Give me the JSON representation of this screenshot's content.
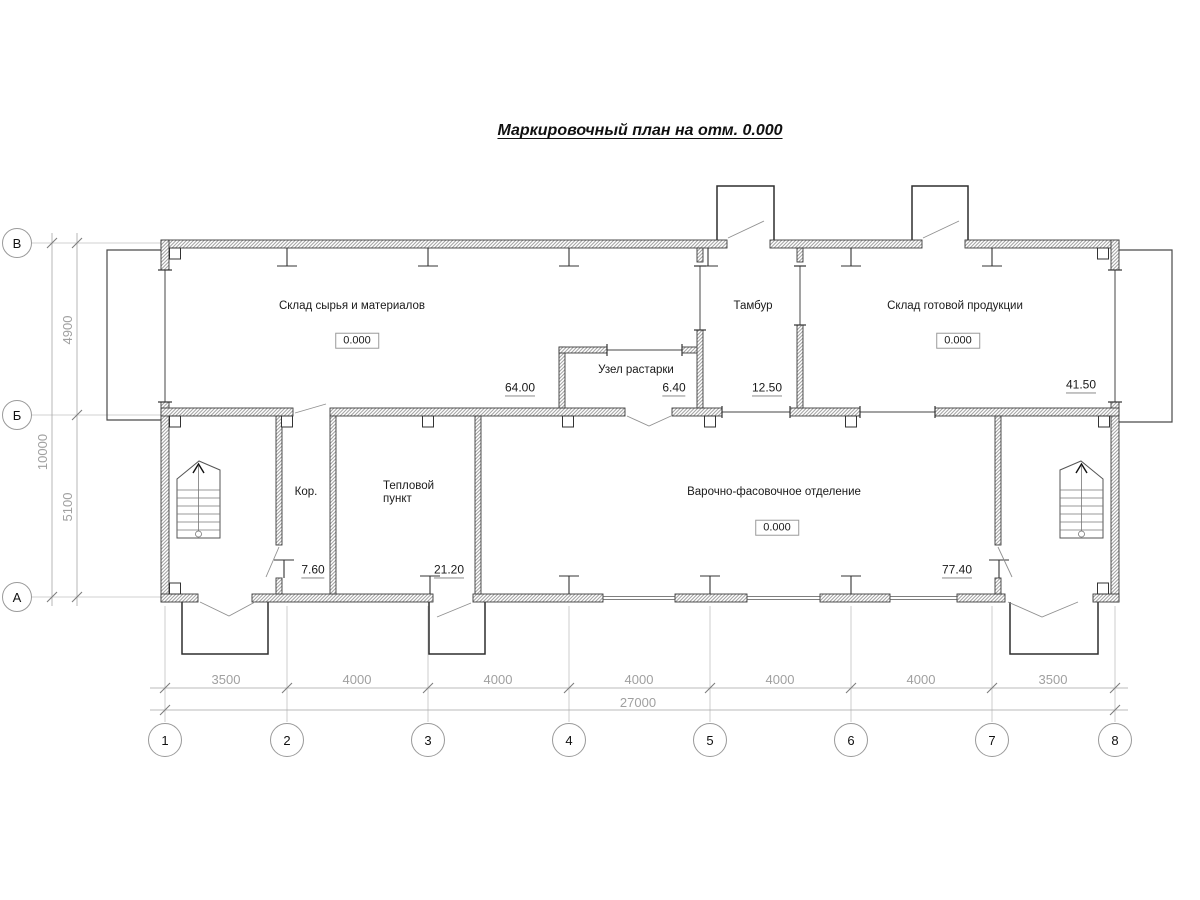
{
  "title": "Маркировочный план на отм. 0.000",
  "rooms": {
    "skladSyrya": {
      "name": "Склад сырья и материалов",
      "elevation": "0.000",
      "area": "64.00"
    },
    "uzelRastarki": {
      "name": "Узел растарки",
      "area": "6.40"
    },
    "tambur": {
      "name": "Тамбур",
      "area": "12.50"
    },
    "skladGotovoy": {
      "name": "Склад готовой продукции",
      "elevation": "0.000",
      "area": "41.50"
    },
    "koridor": {
      "name": "Кор.",
      "area": "7.60"
    },
    "teplopunkt": {
      "name": "Тепловой пункт",
      "area": "21.20"
    },
    "varochnoe": {
      "name": "Варочно-фасовочное отделение",
      "elevation": "0.000",
      "area": "77.40"
    }
  },
  "axes": {
    "row_labels": [
      "В",
      "Б",
      "А"
    ],
    "col_labels": [
      "1",
      "2",
      "3",
      "4",
      "5",
      "6",
      "7",
      "8"
    ]
  },
  "dimensions": {
    "left_segments": [
      "4900",
      "5100"
    ],
    "left_total": "10000",
    "bottom_segments": [
      "3500",
      "4000",
      "4000",
      "4000",
      "4000",
      "4000",
      "3500"
    ],
    "bottom_total": "27000"
  },
  "colors": {
    "wall_outline": "#3c3c3c",
    "dimension_gray": "#a0a0a0",
    "text_black": "#1a1a1a"
  }
}
